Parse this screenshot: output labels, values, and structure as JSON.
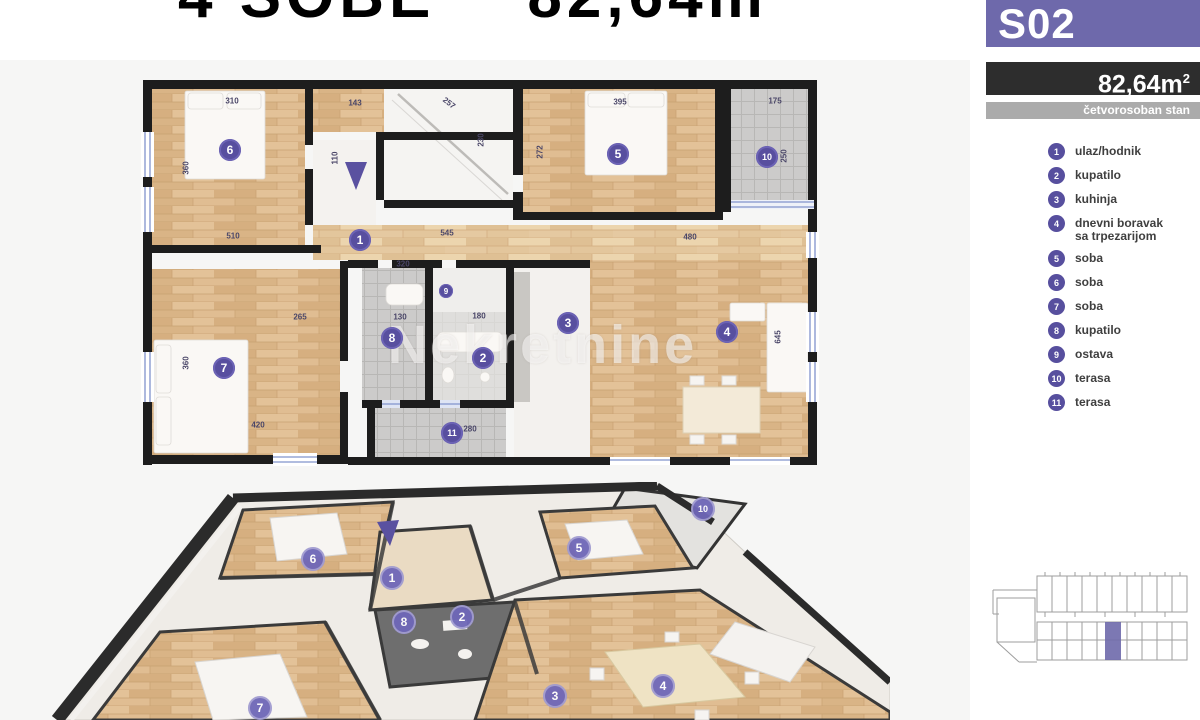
{
  "colors": {
    "accent": "#6e69ab",
    "badge": "#584f9f",
    "title": "#6f6bb2",
    "dark_bar": "#2d2d2d",
    "gray_bar": "#ababab",
    "wood": "#dcb88c",
    "tile": "#cccbca",
    "wall": "#1d1d1d"
  },
  "title": {
    "part1": "4 SOBE",
    "part2": "82,64m",
    "part2_sup": "2"
  },
  "sidebar": {
    "unit_code": "S02",
    "area_value": "82,64m",
    "area_sup": "2",
    "type_label": "četvorosoban stan",
    "legend": [
      {
        "num": "1",
        "label": "ulaz/hodnik"
      },
      {
        "num": "2",
        "label": "kupatilo"
      },
      {
        "num": "3",
        "label": "kuhinja"
      },
      {
        "num": "4",
        "label": "dnevni boravak",
        "label2": "sa trpezarijom"
      },
      {
        "num": "5",
        "label": "soba"
      },
      {
        "num": "6",
        "label": "soba"
      },
      {
        "num": "7",
        "label": "soba"
      },
      {
        "num": "8",
        "label": "kupatilo"
      },
      {
        "num": "9",
        "label": "ostava"
      },
      {
        "num": "10",
        "label": "terasa"
      },
      {
        "num": "11",
        "label": "terasa"
      }
    ]
  },
  "watermark": {
    "text": "Nekretnine"
  },
  "plan2d": {
    "badges": [
      {
        "n": "6",
        "x": 230,
        "y": 150
      },
      {
        "n": "1",
        "x": 360,
        "y": 240
      },
      {
        "n": "5",
        "x": 618,
        "y": 154
      },
      {
        "n": "10",
        "x": 767,
        "y": 157
      },
      {
        "n": "7",
        "x": 224,
        "y": 368
      },
      {
        "n": "8",
        "x": 392,
        "y": 338
      },
      {
        "n": "9",
        "x": 446,
        "y": 291,
        "s": 1
      },
      {
        "n": "2",
        "x": 483,
        "y": 358
      },
      {
        "n": "11",
        "x": 452,
        "y": 433
      },
      {
        "n": "3",
        "x": 568,
        "y": 323
      },
      {
        "n": "4",
        "x": 727,
        "y": 332
      }
    ],
    "dims": [
      {
        "t": "310",
        "x": 232,
        "y": 101
      },
      {
        "t": "360",
        "x": 186,
        "y": 168,
        "r": 1
      },
      {
        "t": "510",
        "x": 233,
        "y": 236
      },
      {
        "t": "143",
        "x": 355,
        "y": 103
      },
      {
        "t": "110",
        "x": 335,
        "y": 158,
        "r": 1
      },
      {
        "t": "257",
        "x": 449,
        "y": 103,
        "d": 1
      },
      {
        "t": "230",
        "x": 481,
        "y": 140,
        "r": 1
      },
      {
        "t": "395",
        "x": 620,
        "y": 102
      },
      {
        "t": "272",
        "x": 540,
        "y": 152,
        "r": 1
      },
      {
        "t": "175",
        "x": 775,
        "y": 101
      },
      {
        "t": "250",
        "x": 784,
        "y": 156,
        "r": 1
      },
      {
        "t": "545",
        "x": 447,
        "y": 233
      },
      {
        "t": "480",
        "x": 690,
        "y": 237
      },
      {
        "t": "320",
        "x": 403,
        "y": 264
      },
      {
        "t": "265",
        "x": 300,
        "y": 317
      },
      {
        "t": "130",
        "x": 400,
        "y": 317
      },
      {
        "t": "180",
        "x": 479,
        "y": 316
      },
      {
        "t": "360",
        "x": 186,
        "y": 363,
        "r": 1
      },
      {
        "t": "420",
        "x": 258,
        "y": 425
      },
      {
        "t": "645",
        "x": 778,
        "y": 337,
        "r": 1
      },
      {
        "t": "280",
        "x": 470,
        "y": 429
      }
    ]
  },
  "plan3d": {
    "badges": [
      {
        "n": "6",
        "x": 313,
        "y": 559
      },
      {
        "n": "1",
        "x": 392,
        "y": 578
      },
      {
        "n": "8",
        "x": 404,
        "y": 622
      },
      {
        "n": "2",
        "x": 462,
        "y": 617
      },
      {
        "n": "5",
        "x": 579,
        "y": 548
      },
      {
        "n": "10",
        "x": 703,
        "y": 509
      },
      {
        "n": "7",
        "x": 260,
        "y": 708
      },
      {
        "n": "4",
        "x": 663,
        "y": 686
      },
      {
        "n": "3",
        "x": 555,
        "y": 696
      }
    ]
  }
}
